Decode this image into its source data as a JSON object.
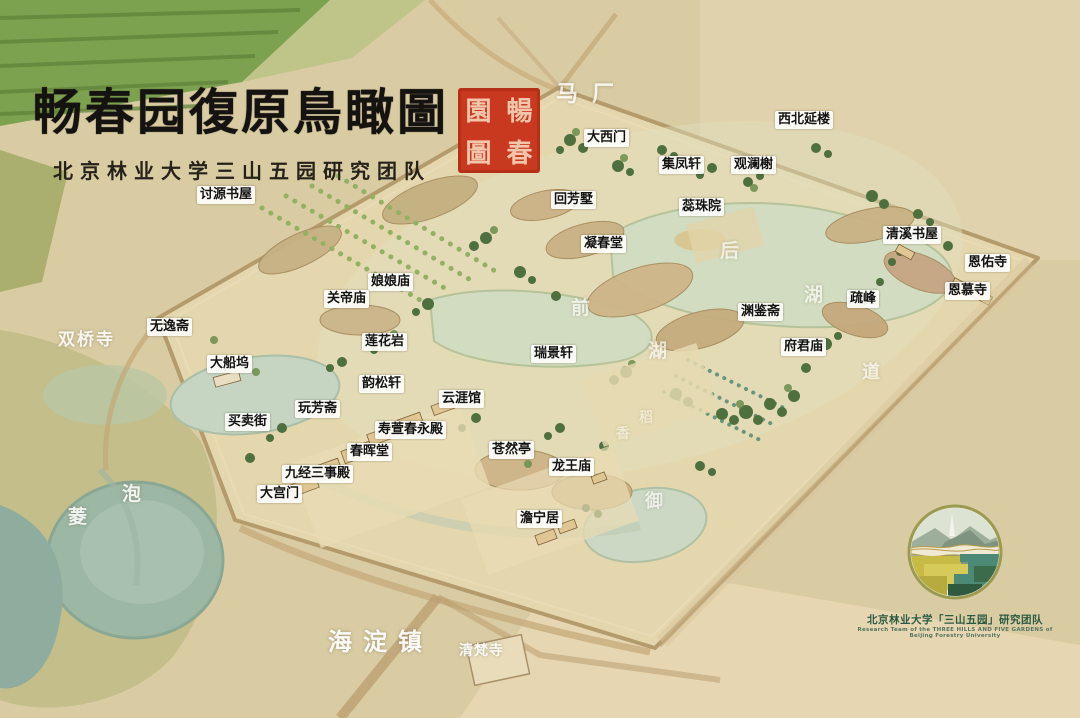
{
  "title": {
    "main": "畅春园復原鳥瞰圖",
    "subtitle": "北京林业大学三山五园研究团队",
    "seal_chars": [
      "園",
      "暢",
      "圖",
      "春"
    ]
  },
  "colors": {
    "seal_red": "#c8391f",
    "label_bg": "#fdfdfa",
    "label_text": "#141414",
    "logo_green": "#2c5a41",
    "parchment": "#d9cba2"
  },
  "box_labels": [
    {
      "text": "大西门",
      "x": 584,
      "y": 129
    },
    {
      "text": "西北延楼",
      "x": 775,
      "y": 111
    },
    {
      "text": "集凤轩",
      "x": 659,
      "y": 156
    },
    {
      "text": "观澜榭",
      "x": 731,
      "y": 156
    },
    {
      "text": "讨源书屋",
      "x": 197,
      "y": 186
    },
    {
      "text": "回芳墅",
      "x": 551,
      "y": 191
    },
    {
      "text": "蕊珠院",
      "x": 679,
      "y": 198
    },
    {
      "text": "凝春堂",
      "x": 581,
      "y": 235
    },
    {
      "text": "清溪书屋",
      "x": 883,
      "y": 226
    },
    {
      "text": "恩佑寺",
      "x": 965,
      "y": 254
    },
    {
      "text": "恩慕寺",
      "x": 945,
      "y": 282
    },
    {
      "text": "疏峰",
      "x": 847,
      "y": 290
    },
    {
      "text": "娘娘庙",
      "x": 368,
      "y": 273
    },
    {
      "text": "关帝庙",
      "x": 324,
      "y": 290
    },
    {
      "text": "渊鉴斋",
      "x": 738,
      "y": 303
    },
    {
      "text": "无逸斋",
      "x": 147,
      "y": 318
    },
    {
      "text": "莲花岩",
      "x": 362,
      "y": 333
    },
    {
      "text": "瑞景轩",
      "x": 531,
      "y": 345
    },
    {
      "text": "府君庙",
      "x": 781,
      "y": 338
    },
    {
      "text": "大船坞",
      "x": 207,
      "y": 355
    },
    {
      "text": "韵松轩",
      "x": 359,
      "y": 375
    },
    {
      "text": "云涯馆",
      "x": 439,
      "y": 390
    },
    {
      "text": "玩芳斋",
      "x": 295,
      "y": 400
    },
    {
      "text": "买卖街",
      "x": 225,
      "y": 413
    },
    {
      "text": "寿萱春永殿",
      "x": 375,
      "y": 421
    },
    {
      "text": "苍然亭",
      "x": 489,
      "y": 441
    },
    {
      "text": "春晖堂",
      "x": 347,
      "y": 443
    },
    {
      "text": "龙王庙",
      "x": 549,
      "y": 458
    },
    {
      "text": "九经三事殿",
      "x": 282,
      "y": 465
    },
    {
      "text": "大宫门",
      "x": 257,
      "y": 485
    },
    {
      "text": "澹宁居",
      "x": 517,
      "y": 510
    }
  ],
  "watermark_labels": [
    {
      "text": "马厂",
      "x": 556,
      "y": 76,
      "size": 22,
      "opacity": 0.8,
      "ls": 14
    },
    {
      "text": "双桥寺",
      "x": 58,
      "y": 325,
      "size": 17,
      "opacity": 0.85,
      "ls": 2
    },
    {
      "text": "泡",
      "x": 122,
      "y": 479,
      "size": 19,
      "opacity": 0.85,
      "ls": 0
    },
    {
      "text": "菱",
      "x": 68,
      "y": 502,
      "size": 19,
      "opacity": 0.85,
      "ls": 0
    },
    {
      "text": "前",
      "x": 571,
      "y": 293,
      "size": 19,
      "opacity": 0.6,
      "ls": 0
    },
    {
      "text": "湖",
      "x": 648,
      "y": 336,
      "size": 19,
      "opacity": 0.6,
      "ls": 0
    },
    {
      "text": "后",
      "x": 720,
      "y": 236,
      "size": 19,
      "opacity": 0.6,
      "ls": 0
    },
    {
      "text": "湖",
      "x": 804,
      "y": 280,
      "size": 19,
      "opacity": 0.6,
      "ls": 0
    },
    {
      "text": "稻",
      "x": 639,
      "y": 407,
      "size": 14,
      "opacity": 0.4,
      "ls": 0
    },
    {
      "text": "香",
      "x": 616,
      "y": 423,
      "size": 14,
      "opacity": 0.4,
      "ls": 0
    },
    {
      "text": "御",
      "x": 645,
      "y": 487,
      "size": 18,
      "opacity": 0.6,
      "ls": 0
    },
    {
      "text": "道",
      "x": 862,
      "y": 358,
      "size": 18,
      "opacity": 0.6,
      "ls": 0
    },
    {
      "text": "海淀镇",
      "x": 328,
      "y": 622,
      "size": 24,
      "opacity": 0.9,
      "ls": 11
    },
    {
      "text": "清梵寺",
      "x": 459,
      "y": 640,
      "size": 14,
      "opacity": 0.9,
      "ls": 1
    }
  ],
  "logo": {
    "cn": "北京林业大学「三山五园」研究团队",
    "en1": "Research Team of the THREE HILLS AND FIVE GARDENS of",
    "en2": "Beijing Forestry University"
  }
}
